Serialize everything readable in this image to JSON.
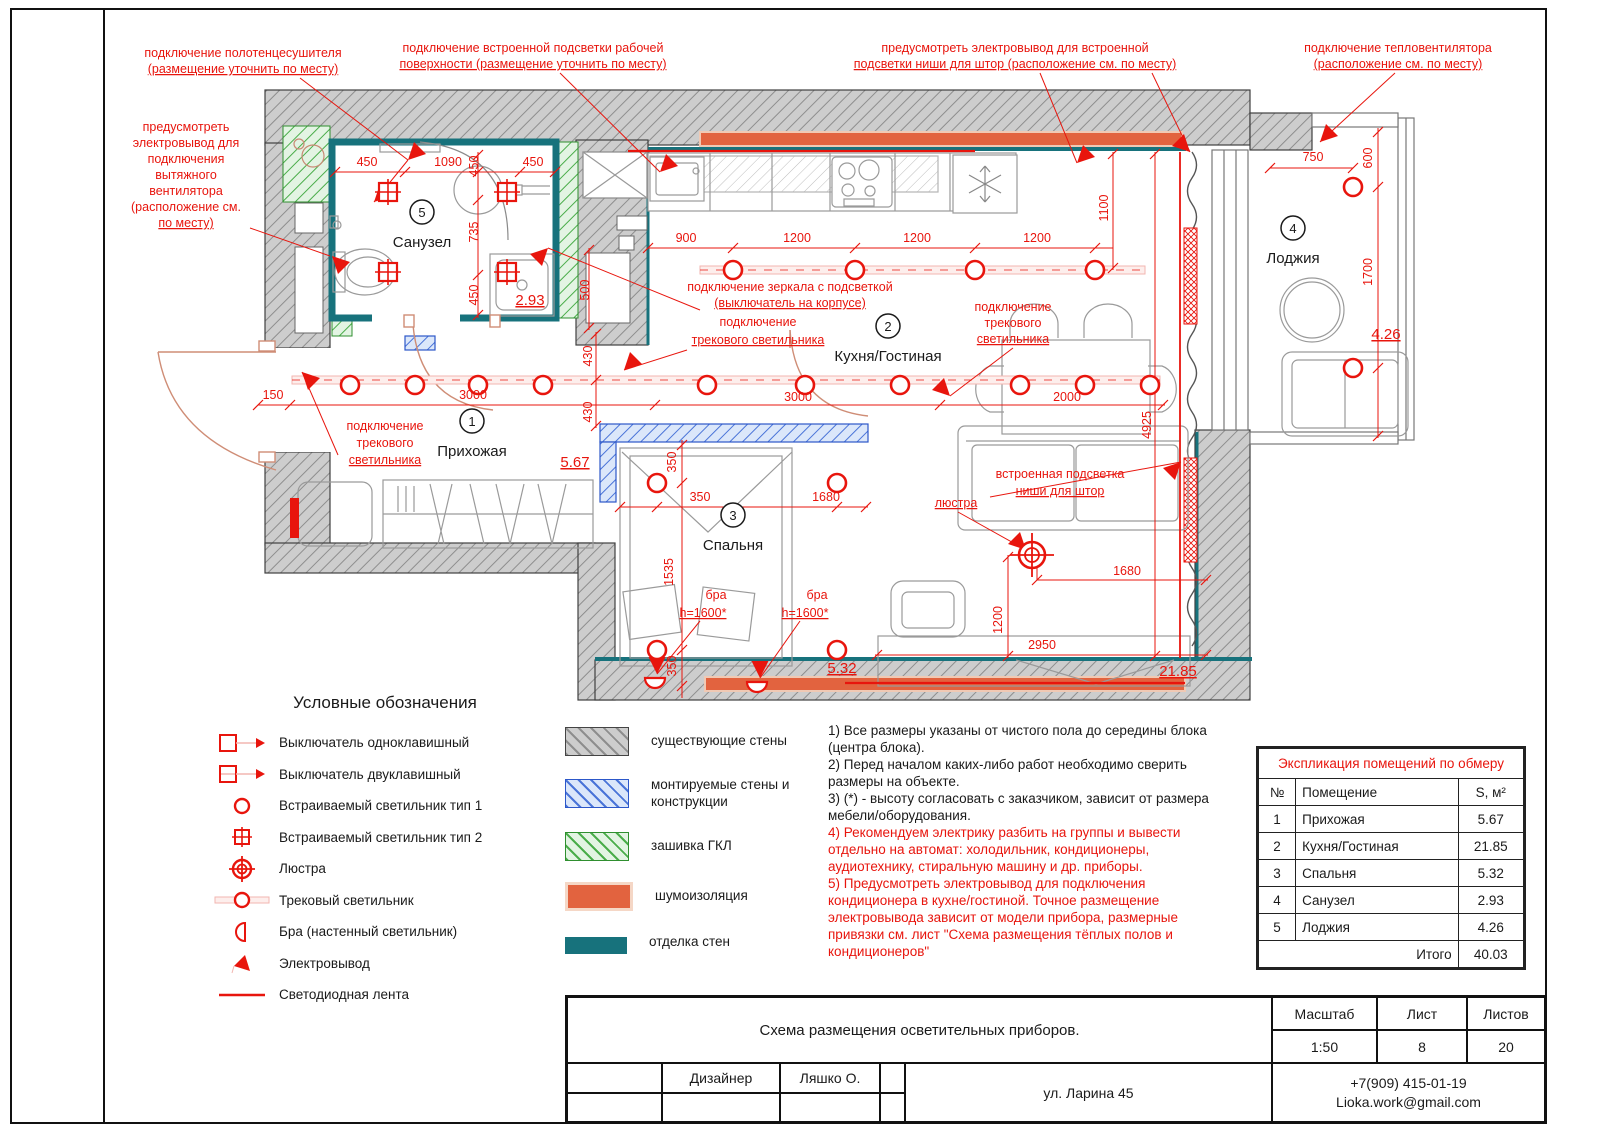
{
  "colors": {
    "red": "#e8150d",
    "teal": "#17727c",
    "orange": "#e2633f",
    "black": "#1a1a1a"
  },
  "legend": {
    "title": "Условные обозначения",
    "items": [
      {
        "icon": "switch-single-icon",
        "label": "Выключатель одноклавишный"
      },
      {
        "icon": "switch-double-icon",
        "label": "Выключатель двуклавишный"
      },
      {
        "icon": "recessed-light-type1-icon",
        "label": "Встраиваемый светильник тип 1"
      },
      {
        "icon": "recessed-light-type2-icon",
        "label": "Встраиваемый светильник тип 2"
      },
      {
        "icon": "chandelier-icon",
        "label": "Люстра"
      },
      {
        "icon": "track-light-icon",
        "label": "Трековый светильник"
      },
      {
        "icon": "sconce-icon",
        "label": "Бра (настенный светильник)"
      },
      {
        "icon": "electrical-outlet-icon",
        "label": "Электровывод"
      },
      {
        "icon": "led-strip-icon",
        "label": "Светодиодная лента"
      }
    ]
  },
  "wall_legend": {
    "items": [
      {
        "type": "existing",
        "label": "существующие стены"
      },
      {
        "type": "mounted",
        "label": "монтируемые стены и конструкции"
      },
      {
        "type": "gkl",
        "label": "зашивка ГКЛ"
      },
      {
        "type": "sound",
        "label": "шумоизоляция"
      },
      {
        "type": "finish",
        "label": "отделка стен"
      }
    ]
  },
  "notes": {
    "items": [
      {
        "color": "black",
        "text": "1) Все размеры указаны от чистого пола до середины блока (центра блока)."
      },
      {
        "color": "black",
        "text": "2) Перед началом каких-либо работ необходимо сверить размеры на объекте."
      },
      {
        "color": "black",
        "text": "3) (*) - высоту согласовать с заказчиком, зависит от размера мебели/оборудования."
      },
      {
        "color": "red",
        "text": "4) Рекомендуем электрику разбить на группы и вывести отдельно на автомат: холодильник, кондиционеры, аудиотехнику, стиральную машину и др. приборы."
      },
      {
        "color": "red",
        "text": "5) Предусмотреть электровывод для подключения кондиционера в кухне/гостиной. Точное размещение электровывода зависит от модели прибора, размерные привязки см. лист \"Схема размещения тёплых полов и кондиционеров\""
      }
    ]
  },
  "room_table": {
    "title": "Экспликация помещений по обмеру",
    "headers": [
      "№",
      "Помещение",
      "S, м²"
    ],
    "rows": [
      [
        "1",
        "Прихожая",
        "5.67"
      ],
      [
        "2",
        "Кухня/Гостиная",
        "21.85"
      ],
      [
        "3",
        "Спальня",
        "5.32"
      ],
      [
        "4",
        "Санузел",
        "2.93"
      ],
      [
        "5",
        "Лоджия",
        "4.26"
      ]
    ],
    "total_label": "Итого",
    "total_value": "40.03"
  },
  "title_block": {
    "drawing_title": "Схема размещения осветительных приборов.",
    "scale_label": "Масштаб",
    "scale_value": "1:50",
    "sheet_label": "Лист",
    "sheet_value": "8",
    "sheets_label": "Листов",
    "sheets_value": "20",
    "designer_label": "Дизайнер",
    "designer_name": "Ляшко О.",
    "address": "ул. Ларина 45",
    "phone": "+7(909) 415-01-19",
    "email": "Lioka.work@gmail.com"
  },
  "plan": {
    "rooms": [
      {
        "number": "1",
        "name": "Прихожая",
        "area": "5.67"
      },
      {
        "number": "2",
        "name": "Кухня/Гостиная",
        "area": "21.85"
      },
      {
        "number": "3",
        "name": "Спальня",
        "area": "5.32"
      },
      {
        "number": "4",
        "name": "Лоджия",
        "area": "4.26"
      },
      {
        "number": "5",
        "name": "Санузел",
        "area": "2.93"
      }
    ],
    "labels": [
      {
        "t": "подключение полотенцесушителя",
        "x": 243,
        "y": 57,
        "n": "annotation-towel-dryer"
      },
      {
        "t": "(размещение уточнить по месту)",
        "x": 243,
        "y": 73,
        "u": 1,
        "n": "annotation-towel-dryer"
      },
      {
        "t": "подключение встроенной подсветки рабочей",
        "x": 533,
        "y": 52,
        "n": "annotation-worktop-light"
      },
      {
        "t": "поверхности (размещение уточнить по месту)",
        "x": 533,
        "y": 68,
        "u": 1,
        "n": "annotation-worktop-light"
      },
      {
        "t": "предусмотреть электровывод для встроенной",
        "x": 1015,
        "y": 52,
        "n": "annotation-curtain-niche-outlet"
      },
      {
        "t": "подсветки ниши для штор (расположение см. по месту)",
        "x": 1015,
        "y": 68,
        "u": 1,
        "n": "annotation-curtain-niche-outlet"
      },
      {
        "t": "подключение тепловентилятора",
        "x": 1398,
        "y": 52,
        "n": "annotation-fan-heater"
      },
      {
        "t": "(расположение см. по месту)",
        "x": 1398,
        "y": 68,
        "u": 1,
        "n": "annotation-fan-heater"
      },
      {
        "t": "предусмотреть",
        "x": 186,
        "y": 131,
        "n": "annotation-exhaust-fan"
      },
      {
        "t": "электровывод для",
        "x": 186,
        "y": 147,
        "n": "annotation-exhaust-fan"
      },
      {
        "t": "подключения",
        "x": 186,
        "y": 163,
        "n": "annotation-exhaust-fan"
      },
      {
        "t": "вытяжного",
        "x": 186,
        "y": 179,
        "n": "annotation-exhaust-fan"
      },
      {
        "t": "вентилятора",
        "x": 186,
        "y": 195,
        "n": "annotation-exhaust-fan"
      },
      {
        "t": "(расположение см.",
        "x": 186,
        "y": 211,
        "n": "annotation-exhaust-fan"
      },
      {
        "t": "по месту)",
        "x": 186,
        "y": 227,
        "u": 1,
        "n": "annotation-exhaust-fan"
      },
      {
        "t": "подключение зеркала с подсветкой",
        "x": 790,
        "y": 291,
        "n": "annotation-mirror-light"
      },
      {
        "t": "(выключатель на корпусе)",
        "x": 790,
        "y": 307,
        "u": 1,
        "n": "annotation-mirror-light"
      },
      {
        "t": "подключение",
        "x": 758,
        "y": 326,
        "n": "annotation-track-light-kitchen"
      },
      {
        "t": "трекового светильника",
        "x": 758,
        "y": 344,
        "u": 1,
        "n": "annotation-track-light-kitchen"
      },
      {
        "t": "подключение",
        "x": 1013,
        "y": 311,
        "n": "annotation-track-light-right"
      },
      {
        "t": "трекового",
        "x": 1013,
        "y": 327,
        "n": "annotation-track-light-right"
      },
      {
        "t": "светильника",
        "x": 1013,
        "y": 343,
        "u": 1,
        "n": "annotation-track-light-right"
      },
      {
        "t": "подключение",
        "x": 385,
        "y": 430,
        "n": "annotation-track-light-hall"
      },
      {
        "t": "трекового",
        "x": 385,
        "y": 447,
        "n": "annotation-track-light-hall"
      },
      {
        "t": "светильника",
        "x": 385,
        "y": 464,
        "u": 1,
        "n": "annotation-track-light-hall"
      },
      {
        "t": "встроенная подсветка",
        "x": 1060,
        "y": 478,
        "n": "annotation-curtain-niche-light"
      },
      {
        "t": "ниши для штор",
        "x": 1060,
        "y": 495,
        "u": 1,
        "n": "annotation-curtain-niche-light"
      },
      {
        "t": "люстра",
        "x": 956,
        "y": 507,
        "u": 1,
        "n": "annotation-chandelier"
      },
      {
        "t": "бра",
        "x": 716,
        "y": 599,
        "n": "annotation-sconce-1"
      },
      {
        "t": "h=1600*",
        "x": 703,
        "y": 617,
        "u": 1,
        "n": "annotation-sconce-1"
      },
      {
        "t": "бра",
        "x": 817,
        "y": 599,
        "n": "annotation-sconce-2"
      },
      {
        "t": "h=1600*",
        "x": 805,
        "y": 617,
        "u": 1,
        "n": "annotation-sconce-2"
      },
      {
        "t": "5",
        "x": 422,
        "y": 217,
        "c": "#1a1a1a",
        "s": 13,
        "n": "room-number-sanuzel"
      },
      {
        "t": "Санузел",
        "x": 422,
        "y": 247,
        "c": "#1a1a1a",
        "s": 15,
        "n": "room-name-sanuzel"
      },
      {
        "t": "2",
        "x": 888,
        "y": 331,
        "c": "#1a1a1a",
        "s": 13,
        "n": "room-number-kitchen"
      },
      {
        "t": "Кухня/Гостиная",
        "x": 888,
        "y": 361,
        "c": "#1a1a1a",
        "s": 15,
        "n": "room-name-kitchen"
      },
      {
        "t": "1",
        "x": 472,
        "y": 426,
        "c": "#1a1a1a",
        "s": 13,
        "n": "room-number-hall"
      },
      {
        "t": "Прихожая",
        "x": 472,
        "y": 456,
        "c": "#1a1a1a",
        "s": 15,
        "n": "room-name-hall"
      },
      {
        "t": "3",
        "x": 733,
        "y": 520,
        "c": "#1a1a1a",
        "s": 13,
        "n": "room-number-bedroom"
      },
      {
        "t": "Спальня",
        "x": 733,
        "y": 550,
        "c": "#1a1a1a",
        "s": 15,
        "n": "room-name-bedroom"
      },
      {
        "t": "4",
        "x": 1293,
        "y": 233,
        "c": "#1a1a1a",
        "s": 13,
        "n": "room-number-loggia"
      },
      {
        "t": "Лоджия",
        "x": 1293,
        "y": 263,
        "c": "#1a1a1a",
        "s": 15,
        "n": "room-name-loggia"
      },
      {
        "t": "5.67",
        "x": 575,
        "y": 467,
        "u": 1,
        "s": 15,
        "n": "area-hall"
      },
      {
        "t": "2.93",
        "x": 530,
        "y": 305,
        "u": 1,
        "s": 15,
        "n": "area-sanuzel"
      },
      {
        "t": "5.32",
        "x": 842,
        "y": 673,
        "u": 1,
        "s": 15,
        "n": "area-bedroom"
      },
      {
        "t": "21.85",
        "x": 1178,
        "y": 676,
        "u": 1,
        "s": 15,
        "n": "area-kitchen"
      },
      {
        "t": "4.26",
        "x": 1386,
        "y": 339,
        "u": 1,
        "s": 15,
        "n": "area-loggia"
      },
      {
        "t": "450",
        "x": 367,
        "y": 166,
        "n": "dim-label"
      },
      {
        "t": "1090",
        "x": 448,
        "y": 166,
        "n": "dim-label"
      },
      {
        "t": "450",
        "x": 478,
        "y": 166,
        "r": -90,
        "n": "dim-label"
      },
      {
        "t": "450",
        "x": 533,
        "y": 166,
        "n": "dim-label"
      },
      {
        "t": "735",
        "x": 478,
        "y": 232,
        "r": -90,
        "n": "dim-label"
      },
      {
        "t": "450",
        "x": 478,
        "y": 295,
        "r": -90,
        "n": "dim-label"
      },
      {
        "t": "500",
        "x": 589,
        "y": 290,
        "r": -90,
        "n": "dim-label"
      },
      {
        "t": "900",
        "x": 686,
        "y": 242,
        "n": "dim-label"
      },
      {
        "t": "1200",
        "x": 797,
        "y": 242,
        "n": "dim-label"
      },
      {
        "t": "1200",
        "x": 917,
        "y": 242,
        "n": "dim-label"
      },
      {
        "t": "1200",
        "x": 1037,
        "y": 242,
        "n": "dim-label"
      },
      {
        "t": "1100",
        "x": 1108,
        "y": 208,
        "r": -90,
        "n": "dim-label"
      },
      {
        "t": "150",
        "x": 273,
        "y": 399,
        "n": "dim-label"
      },
      {
        "t": "3000",
        "x": 473,
        "y": 399,
        "n": "dim-label"
      },
      {
        "t": "430",
        "x": 592,
        "y": 356,
        "r": -90,
        "n": "dim-label"
      },
      {
        "t": "430",
        "x": 592,
        "y": 412,
        "r": -90,
        "n": "dim-label"
      },
      {
        "t": "3000",
        "x": 798,
        "y": 401,
        "n": "dim-label"
      },
      {
        "t": "2000",
        "x": 1067,
        "y": 401,
        "n": "dim-label"
      },
      {
        "t": "4925",
        "x": 1151,
        "y": 425,
        "r": -90,
        "n": "dim-label"
      },
      {
        "t": "350",
        "x": 676,
        "y": 462,
        "r": -90,
        "n": "dim-label"
      },
      {
        "t": "350",
        "x": 700,
        "y": 501,
        "n": "dim-label"
      },
      {
        "t": "1680",
        "x": 826,
        "y": 501,
        "n": "dim-label"
      },
      {
        "t": "1535",
        "x": 673,
        "y": 572,
        "r": -90,
        "n": "dim-label"
      },
      {
        "t": "350",
        "x": 676,
        "y": 666,
        "r": -90,
        "n": "dim-label"
      },
      {
        "t": "750",
        "x": 1313,
        "y": 161,
        "n": "dim-label"
      },
      {
        "t": "600",
        "x": 1372,
        "y": 158,
        "r": -90,
        "n": "dim-label"
      },
      {
        "t": "1700",
        "x": 1372,
        "y": 272,
        "r": -90,
        "n": "dim-label"
      },
      {
        "t": "1680",
        "x": 1127,
        "y": 575,
        "n": "dim-label"
      },
      {
        "t": "1200",
        "x": 1002,
        "y": 620,
        "r": -90,
        "n": "dim-label"
      },
      {
        "t": "2950",
        "x": 1042,
        "y": 649,
        "n": "dim-label"
      }
    ]
  }
}
